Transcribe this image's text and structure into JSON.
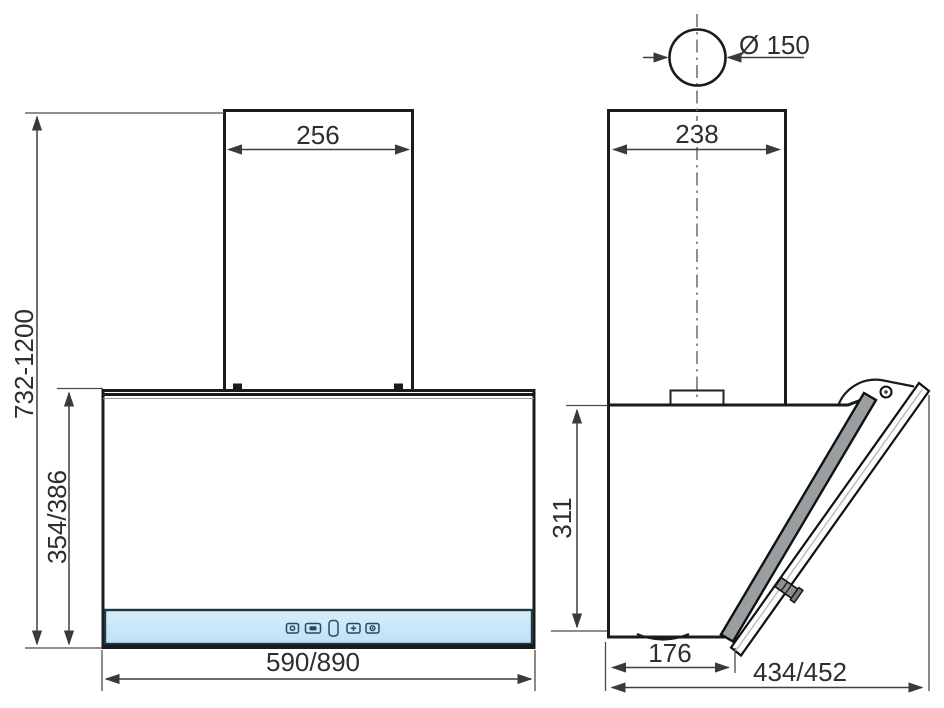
{
  "drawing": {
    "type": "technical-dimensional-drawing",
    "subject": "wall-mounted range hood, front and side views"
  },
  "dims": {
    "front_chimney_width": "256",
    "front_total_height": "732-1200",
    "front_glass_height": "354/386",
    "front_body_width": "590/890",
    "side_duct_diameter": "Ø 150",
    "side_chimney_depth": "238",
    "side_body_height": "311",
    "side_bottom_depth": "176",
    "side_total_depth": "434/452"
  },
  "control_panel": {
    "icons": [
      "power-icon",
      "fan-icon",
      "display-icon",
      "plus-icon",
      "light-icon"
    ]
  },
  "colors": {
    "outline": "#1b1b1b",
    "dimension_line": "#3f3f3f",
    "glass_blue": "#cde8f8",
    "panel_blue": "#c7e6f8",
    "steel_light": "#f5f5f5",
    "steel_dark": "#9aa0a2",
    "background": "#ffffff"
  }
}
